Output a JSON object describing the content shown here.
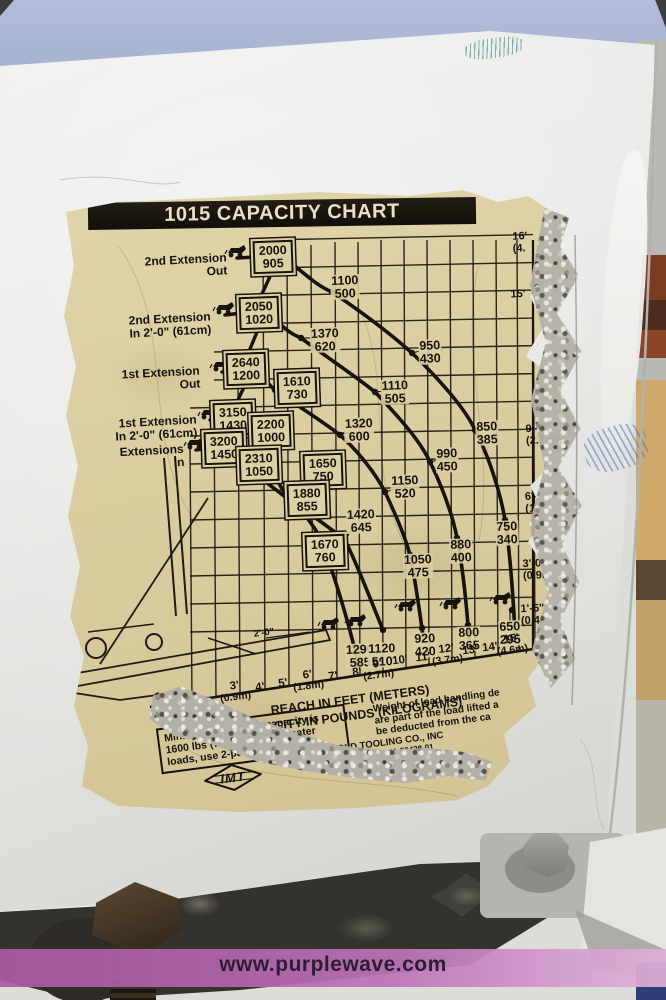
{
  "scene": {
    "watermark": "www.purplewave.com",
    "colors": {
      "purple_stripe": "#b164ae",
      "sticker_paper": "#d9cda0",
      "ink": "#17120b",
      "panel_white": "#e9e9e7",
      "sky": "#a9b5d2"
    }
  },
  "sticker": {
    "title": "1015 CAPACITY CHART",
    "logo": "IMT",
    "boom_label": "2'-0\"",
    "axis": {
      "reach": "REACH IN FEET (METERS)",
      "capacity": "CAPACITY IN POUNDS (KILOGRAMS)"
    },
    "extension_labels": [
      {
        "line1": "2nd Extension",
        "line2": "Out",
        "x": 128,
        "y": 80
      },
      {
        "line1": "2nd Extension",
        "line2": "In 2'-0\" (61cm)",
        "x": 112,
        "y": 139
      },
      {
        "line1": "1st Extension",
        "line2": "Out",
        "x": 103,
        "y": 193
      },
      {
        "line1": "1st Extension",
        "line2": "In 2'-0\" (61cm)",
        "x": 98,
        "y": 242
      },
      {
        "line1": "Extensions",
        "line2": "In",
        "x": 94,
        "y": 271
      }
    ],
    "height_labels": [
      {
        "t": "16'",
        "m": "(4.",
        "x": 462,
        "y": 57
      },
      {
        "t": "15'",
        "m": "",
        "x": 460,
        "y": 109
      },
      {
        "t": "",
        "m": "m)",
        "x": 492,
        "y": 190
      },
      {
        "t": "9'-0\"",
        "m": "(2.7m)",
        "x": 484,
        "y": 249
      },
      {
        "t": "6'-0\"",
        "m": "(1.",
        "x": 479,
        "y": 317
      },
      {
        "t": "3'-0\"",
        "m": "(0.9m)",
        "x": 481,
        "y": 384
      },
      {
        "t": "1'-5\"",
        "m": "(0.4m)",
        "x": 479,
        "y": 429
      }
    ],
    "x_ticks": [
      {
        "t": "0",
        "m": "",
        "x": 100,
        "y": 512
      },
      {
        "t": "3'",
        "m": "(0.9m)",
        "x": 177,
        "y": 506
      },
      {
        "t": "4'",
        "m": "",
        "x": 202,
        "y": 502
      },
      {
        "t": "5'",
        "m": "",
        "x": 225,
        "y": 498
      },
      {
        "t": "6'",
        "m": "(1.8m)",
        "x": 250,
        "y": 495
      },
      {
        "t": "7'",
        "m": "",
        "x": 275,
        "y": 491
      },
      {
        "t": "8'",
        "m": "",
        "x": 299,
        "y": 487
      },
      {
        "t": "9'",
        "m": "(2.7m)",
        "x": 320,
        "y": 484
      },
      {
        "t": "10'",
        "m": "",
        "x": 342,
        "y": 475
      },
      {
        "t": "11'",
        "m": "",
        "x": 365,
        "y": 472
      },
      {
        "t": "12'",
        "m": "(3.7m)",
        "x": 389,
        "y": 469
      },
      {
        "t": "13'",
        "m": "",
        "x": 412,
        "y": 465
      },
      {
        "t": "14'",
        "m": "",
        "x": 432,
        "y": 462
      },
      {
        "t": "15'",
        "m": "(4.6m)",
        "x": 454,
        "y": 459
      }
    ],
    "one_part_note": {
      "l1": "Minimum 1-part line capacity is",
      "l2": "1600 lbs (725 kgs).",
      "l3": "For greater loads, use 2-part line."
    },
    "weight_note": {
      "l1": "Weight of load handling de",
      "l2": "are part of the load lifted a",
      "l3": "be deducted from the ca"
    },
    "company": {
      "l1": "IOWA MOLD TOOLING CO., INC",
      "l2": "BOX 189, GARNER, IA 50438-01",
      "l3": "TEL: 641-923-3711  FAX: 64"
    }
  },
  "chart_data": {
    "type": "line",
    "title": "1015 CAPACITY CHART",
    "xlabel": "REACH IN FEET (METERS)",
    "ylabel": "CAPACITY IN POUNDS (KILOGRAMS)",
    "x_ticks": [
      "0",
      "3'",
      "4'",
      "5'",
      "6'",
      "7'",
      "8'",
      "9'",
      "10'",
      "11'",
      "12'",
      "13'",
      "14'",
      "15'"
    ],
    "x_tick_meters": {
      "3'": "0.9m",
      "6'": "1.8m",
      "9'": "2.7m",
      "12'": "3.7m",
      "15'": "4.6m"
    },
    "hook_height_ticks": [
      "16' (4.",
      "15'",
      "9'-0\" (2.7m)",
      "6'-0\" (1.",
      "3'-0\" (0.9m)",
      "1'-5\" (0.4m)"
    ],
    "grid": true,
    "series": [
      {
        "name": "Extensions In",
        "capacities_lb_kg": [
          [
            3200,
            1450
          ],
          [
            2310,
            1050
          ],
          [
            1650,
            750
          ],
          [
            1670,
            760
          ],
          [
            1290,
            585
          ]
        ]
      },
      {
        "name": "1st Extension In 2'-0\" (61cm)",
        "capacities_lb_kg": [
          [
            3150,
            1430
          ],
          [
            2200,
            1000
          ],
          [
            1880,
            855
          ],
          [
            1420,
            645
          ],
          [
            1120,
            510
          ]
        ]
      },
      {
        "name": "1st Extension Out",
        "capacities_lb_kg": [
          [
            2640,
            1200
          ],
          [
            1610,
            730
          ],
          [
            1320,
            600
          ],
          [
            1150,
            520
          ],
          [
            1050,
            475
          ],
          [
            920,
            420
          ]
        ]
      },
      {
        "name": "2nd Extension In 2'-0\" (61cm)",
        "capacities_lb_kg": [
          [
            2050,
            1020
          ],
          [
            1370,
            620
          ],
          [
            1110,
            505
          ],
          [
            990,
            450
          ],
          [
            880,
            400
          ],
          [
            800,
            365
          ]
        ]
      },
      {
        "name": "2nd Extension Out",
        "capacities_lb_kg": [
          [
            2000,
            905
          ],
          [
            1100,
            500
          ],
          [
            950,
            430
          ],
          [
            850,
            385
          ],
          [
            750,
            340
          ],
          [
            650,
            295
          ]
        ]
      }
    ],
    "point_labels": [
      {
        "lb": "2000",
        "kg": "905",
        "x": 215,
        "y": 71,
        "boxed": true
      },
      {
        "lb": "2050",
        "kg": "1020",
        "x": 201,
        "y": 127,
        "boxed": true
      },
      {
        "lb": "2640",
        "kg": "1200",
        "x": 188,
        "y": 183,
        "boxed": true
      },
      {
        "lb": "1610",
        "kg": "730",
        "x": 239,
        "y": 202,
        "boxed": true
      },
      {
        "lb": "3150",
        "kg": "1430",
        "x": 175,
        "y": 233,
        "boxed": true
      },
      {
        "lb": "2200",
        "kg": "1000",
        "x": 213,
        "y": 245,
        "boxed": true
      },
      {
        "lb": "3200",
        "kg": "1450",
        "x": 166,
        "y": 262,
        "boxed": true
      },
      {
        "lb": "2310",
        "kg": "1050",
        "x": 201,
        "y": 279,
        "boxed": true
      },
      {
        "lb": "1650",
        "kg": "750",
        "x": 265,
        "y": 284,
        "boxed": true
      },
      {
        "lb": "1880",
        "kg": "855",
        "x": 249,
        "y": 314,
        "boxed": true
      },
      {
        "lb": "1670",
        "kg": "760",
        "x": 267,
        "y": 365,
        "boxed": true
      },
      {
        "lb": "1100",
        "kg": "500",
        "x": 287,
        "y": 101,
        "boxed": false
      },
      {
        "lb": "1370",
        "kg": "620",
        "x": 267,
        "y": 154,
        "boxed": false
      },
      {
        "lb": "950",
        "kg": "430",
        "x": 372,
        "y": 166,
        "boxed": false
      },
      {
        "lb": "1110",
        "kg": "505",
        "x": 337,
        "y": 206,
        "boxed": false
      },
      {
        "lb": "1320",
        "kg": "600",
        "x": 301,
        "y": 244,
        "boxed": false
      },
      {
        "lb": "850",
        "kg": "385",
        "x": 429,
        "y": 247,
        "boxed": false
      },
      {
        "lb": "990",
        "kg": "450",
        "x": 389,
        "y": 274,
        "boxed": false
      },
      {
        "lb": "1150",
        "kg": "520",
        "x": 347,
        "y": 301,
        "boxed": false
      },
      {
        "lb": "1420",
        "kg": "645",
        "x": 303,
        "y": 335,
        "boxed": false
      },
      {
        "lb": "750",
        "kg": "340",
        "x": 449,
        "y": 347,
        "boxed": false
      },
      {
        "lb": "880",
        "kg": "400",
        "x": 403,
        "y": 365,
        "boxed": false
      },
      {
        "lb": "1050",
        "kg": "475",
        "x": 360,
        "y": 380,
        "boxed": false
      },
      {
        "lb": "920",
        "kg": "420",
        "x": 367,
        "y": 459,
        "boxed": false
      },
      {
        "lb": "800",
        "kg": "365",
        "x": 411,
        "y": 453,
        "boxed": false
      },
      {
        "lb": "650",
        "kg": "295",
        "x": 452,
        "y": 447,
        "boxed": false
      },
      {
        "lb": "1290",
        "kg": "585",
        "x": 302,
        "y": 470,
        "boxed": false
      },
      {
        "lb": "1120",
        "kg": "510",
        "x": 324,
        "y": 469,
        "boxed": false
      }
    ],
    "notes": "Minimum 1-part line capacity is 1600 lbs (725 kgs). For greater loads, use 2-part line."
  }
}
